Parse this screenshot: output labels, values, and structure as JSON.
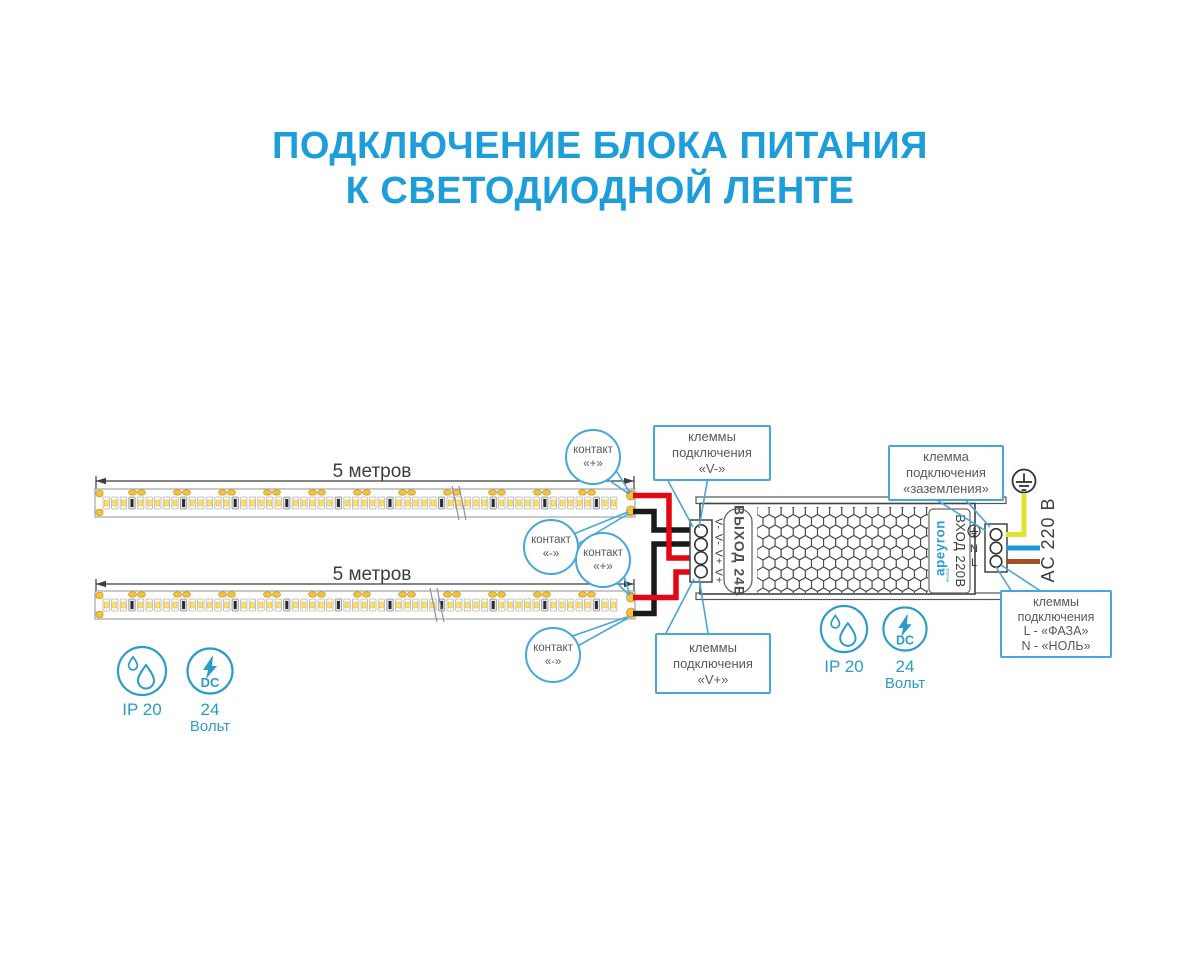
{
  "title": {
    "line1": "ПОДКЛЮЧЕНИЕ БЛОКА ПИТАНИЯ",
    "line2": "К СВЕТОДИОДНОЙ ЛЕНТЕ"
  },
  "strips": {
    "strip1_label": "5 метров",
    "strip2_label": "5 метров"
  },
  "callouts": {
    "contact_plus_1": {
      "line1": "контакт",
      "line2": "«+»"
    },
    "contact_minus_1": {
      "line1": "контакт",
      "line2": "«-»"
    },
    "contact_plus_2": {
      "line1": "контакт",
      "line2": "«+»"
    },
    "contact_minus_2": {
      "line1": "контакт",
      "line2": "«-»"
    },
    "terminals_vminus": {
      "line1": "клеммы",
      "line2": "подключения",
      "line3": "«V-»"
    },
    "terminals_vplus": {
      "line1": "клеммы",
      "line2": "подключения",
      "line3": "«V+»"
    },
    "terminal_ground": {
      "line1": "клемма",
      "line2": "подключения",
      "line3": "«заземления»"
    },
    "terminals_mains": {
      "line1": "клеммы",
      "line2": "подключения",
      "line3": "L - «ФАЗА»",
      "line4": "N - «НОЛЬ»"
    }
  },
  "psu": {
    "output_label": "ВЫХОД 24В",
    "output_terminals": "V- V- V+ V+",
    "brand": "apeyron",
    "brand_sub": "electric",
    "input_label": "ВХОД 220В",
    "neutral": "N",
    "line": "L",
    "mains_label": "AC 220 В"
  },
  "badges": {
    "left": {
      "ip": "IP 20",
      "dc": "DC",
      "volts": "24",
      "volts_unit": "Вольт"
    },
    "right": {
      "ip": "IP 20",
      "dc": "DC",
      "volts": "24",
      "volts_unit": "Вольт"
    }
  },
  "colors": {
    "title_blue": "#1D9DD9",
    "callout_blue": "#45A7DA",
    "text_gray": "#58595B",
    "wire_red": "#E30613",
    "wire_black": "#1A1A1A",
    "wire_yellow": "#E4E02F",
    "wire_blue": "#1E9BD7",
    "wire_brown": "#A0512B",
    "icon_teal": "#2B9CC9",
    "pad_gold": "#F2C33C"
  }
}
